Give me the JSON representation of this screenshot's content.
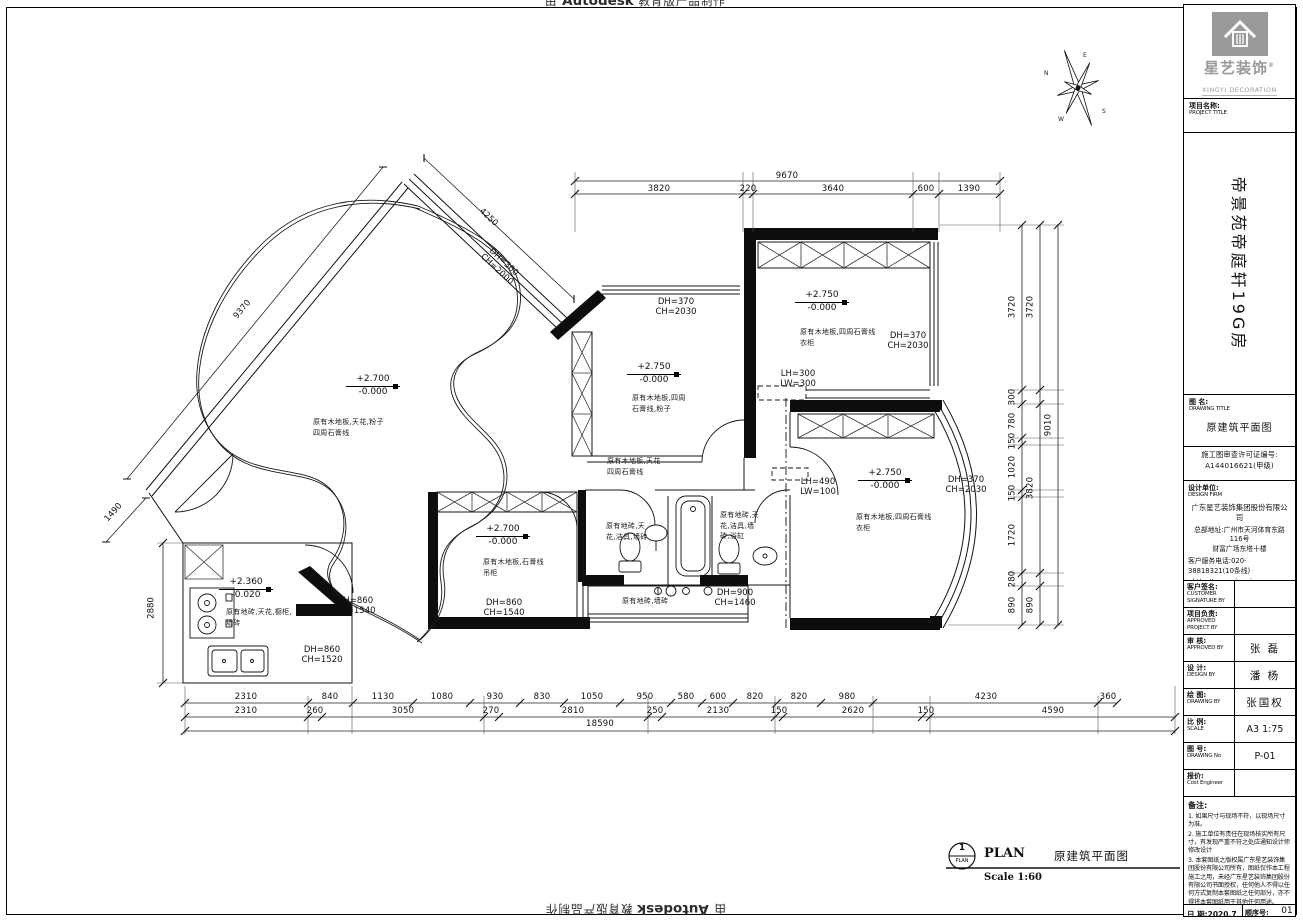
{
  "watermark": {
    "prefix": "由",
    "brand": "Autodesk",
    "suffix": "教育版产品制作"
  },
  "compass": {
    "n": "N",
    "e": "E",
    "s": "S",
    "w": "W"
  },
  "sidebar": {
    "brand": "星艺装饰",
    "brand_reg": "®",
    "brand_en": "XINGYI DECORATION",
    "project_label": "项目名称:",
    "project_label_en": "PROJECT TITLE",
    "project_name": "帝景苑帝庭轩19G房",
    "drawing_label": "图 名:",
    "drawing_label_en": "DRAWING TITLE",
    "drawing_title": "原建筑平面图",
    "license1": "施工图审查许可证编号:",
    "license2": "A144016621(甲级)",
    "firm_label": "设计单位:",
    "firm_label_en": "DESIGN FIRM",
    "firm_name": "广东星艺装饰集团股份有限公司",
    "firm_addr1": "总部地址:广州市天河体育东路116号",
    "firm_addr2": "财富广场东塔十楼",
    "firm_phone": "客户服务电话:020-38818321(10条线)",
    "firm_web": "http://www.xingyigz.com.cn",
    "rows": [
      {
        "label": "客户签名:",
        "en": "CUSTOMER SIGNATURE BY",
        "value": ""
      },
      {
        "label": "项目负责:",
        "en": "APPROVED PROJECT BY",
        "value": ""
      },
      {
        "label": "审 核:",
        "en": "APPROVED BY",
        "value": "张 磊"
      },
      {
        "label": "设 计:",
        "en": "DESIGN BY",
        "value": "潘 杨"
      },
      {
        "label": "绘 图:",
        "en": "DRAWING BY",
        "value": "张国权"
      },
      {
        "label": "比 例:",
        "en": "SCALE",
        "value": "A3 1:75"
      },
      {
        "label": "图 号:",
        "en": "DRAWING No",
        "value": "P-01"
      },
      {
        "label": "报价:",
        "en": "Cost Engineer",
        "value": ""
      }
    ],
    "notes_label": "备注:",
    "note1": "1. 如果尺寸与现场不符，以现场尺寸为准。",
    "note2": "2. 施工单位有责任在现场核实所有尺寸，有发现严重不符之处应通知设计师修改设计",
    "note3": "3. 本套图纸之版权属广东星艺装饰集团股份有限公司所有，图纸仅作本工程施工之用，未经广东星艺装饰集团股份有限公司书面授权，任何他人不得以任何方式复制本套图纸之任何部分，亦不得将本套图纸用于其他任何用途。",
    "date_label": "日 期:2020.7",
    "date_en": "DATE",
    "no_label": "顺序号:",
    "no_en": "NO.",
    "no_value": "01"
  },
  "plan": {
    "title_no": "1",
    "title_ref": "PLAN",
    "title_en": "PLAN",
    "title_cn": "原建筑平面图",
    "title_scale": "Scale 1:60",
    "levels": [
      {
        "up": "+2.700",
        "down": "-0.000"
      },
      {
        "up": "+2.750",
        "down": "-0.000"
      },
      {
        "up": "+2.750",
        "down": "-0.000"
      },
      {
        "up": "+2.750",
        "down": "-0.000"
      },
      {
        "up": "+2.700",
        "down": "-0.000"
      },
      {
        "up": "+2.360",
        "down": "-0.020"
      }
    ],
    "finishes": {
      "living": "原有木地板,天花,粉子\n四周石膏线",
      "bed_mid": "原有木地板,四周\n石膏线,粉子",
      "bed_tr": "原有木地板,四周石膏线\n衣柜",
      "master": "原有木地板,四周石膏线\n衣柜",
      "bed_small": "原有木地板,石膏线\n吊柜",
      "kitchen": "原有地砖,天花,橱柜,\n墙砖",
      "corridor": "原有木地板,天花\n四周石膏线",
      "bath1": "原有地砖,天\n花,洁具,墙砖",
      "bath2": "原有地砖,天\n花,洁具,墙\n砖,浴缸",
      "balcony": "原有地砖,墙砖"
    },
    "tags": [
      {
        "a": "DH=300",
        "b": "CH=2000"
      },
      {
        "a": "DH=370",
        "b": "CH=2030"
      },
      {
        "a": "DH=370",
        "b": "CH=2030"
      },
      {
        "a": "LH=300",
        "b": "LW=300"
      },
      {
        "a": "DH=370",
        "b": "CH=2030"
      },
      {
        "a": "LH=490",
        "b": "LW=100"
      },
      {
        "a": "DH=860",
        "b": "CH=1540"
      },
      {
        "a": "DH=860",
        "b": "CH=1540"
      },
      {
        "a": "DH=860",
        "b": "CH=1520"
      },
      {
        "a": "DH=900",
        "b": "CH=1460"
      }
    ],
    "dims": {
      "top_total": "9670",
      "top": [
        "3820",
        "220",
        "3640",
        "600",
        "1390"
      ],
      "bottom1": [
        "2310",
        "840",
        "1130",
        "1080",
        "930",
        "830",
        "1050",
        "950",
        "580",
        "600",
        "820",
        "820",
        "980",
        "4230",
        "360"
      ],
      "bottom2": [
        "2310",
        "260",
        "3050",
        "270",
        "2810",
        "250",
        "2130",
        "150",
        "2620",
        "150",
        "4590"
      ],
      "bottom_total": "18590",
      "right_inner": [
        "3720",
        "300",
        "780",
        "150",
        "1020",
        "150",
        "1720",
        "280",
        "890"
      ],
      "right_mid": [
        "3720",
        "3820",
        "890"
      ],
      "right_total": "9010",
      "diag_long": "9370",
      "diag_top": "4250",
      "diag_small": "1490",
      "left_v": "2880"
    }
  }
}
